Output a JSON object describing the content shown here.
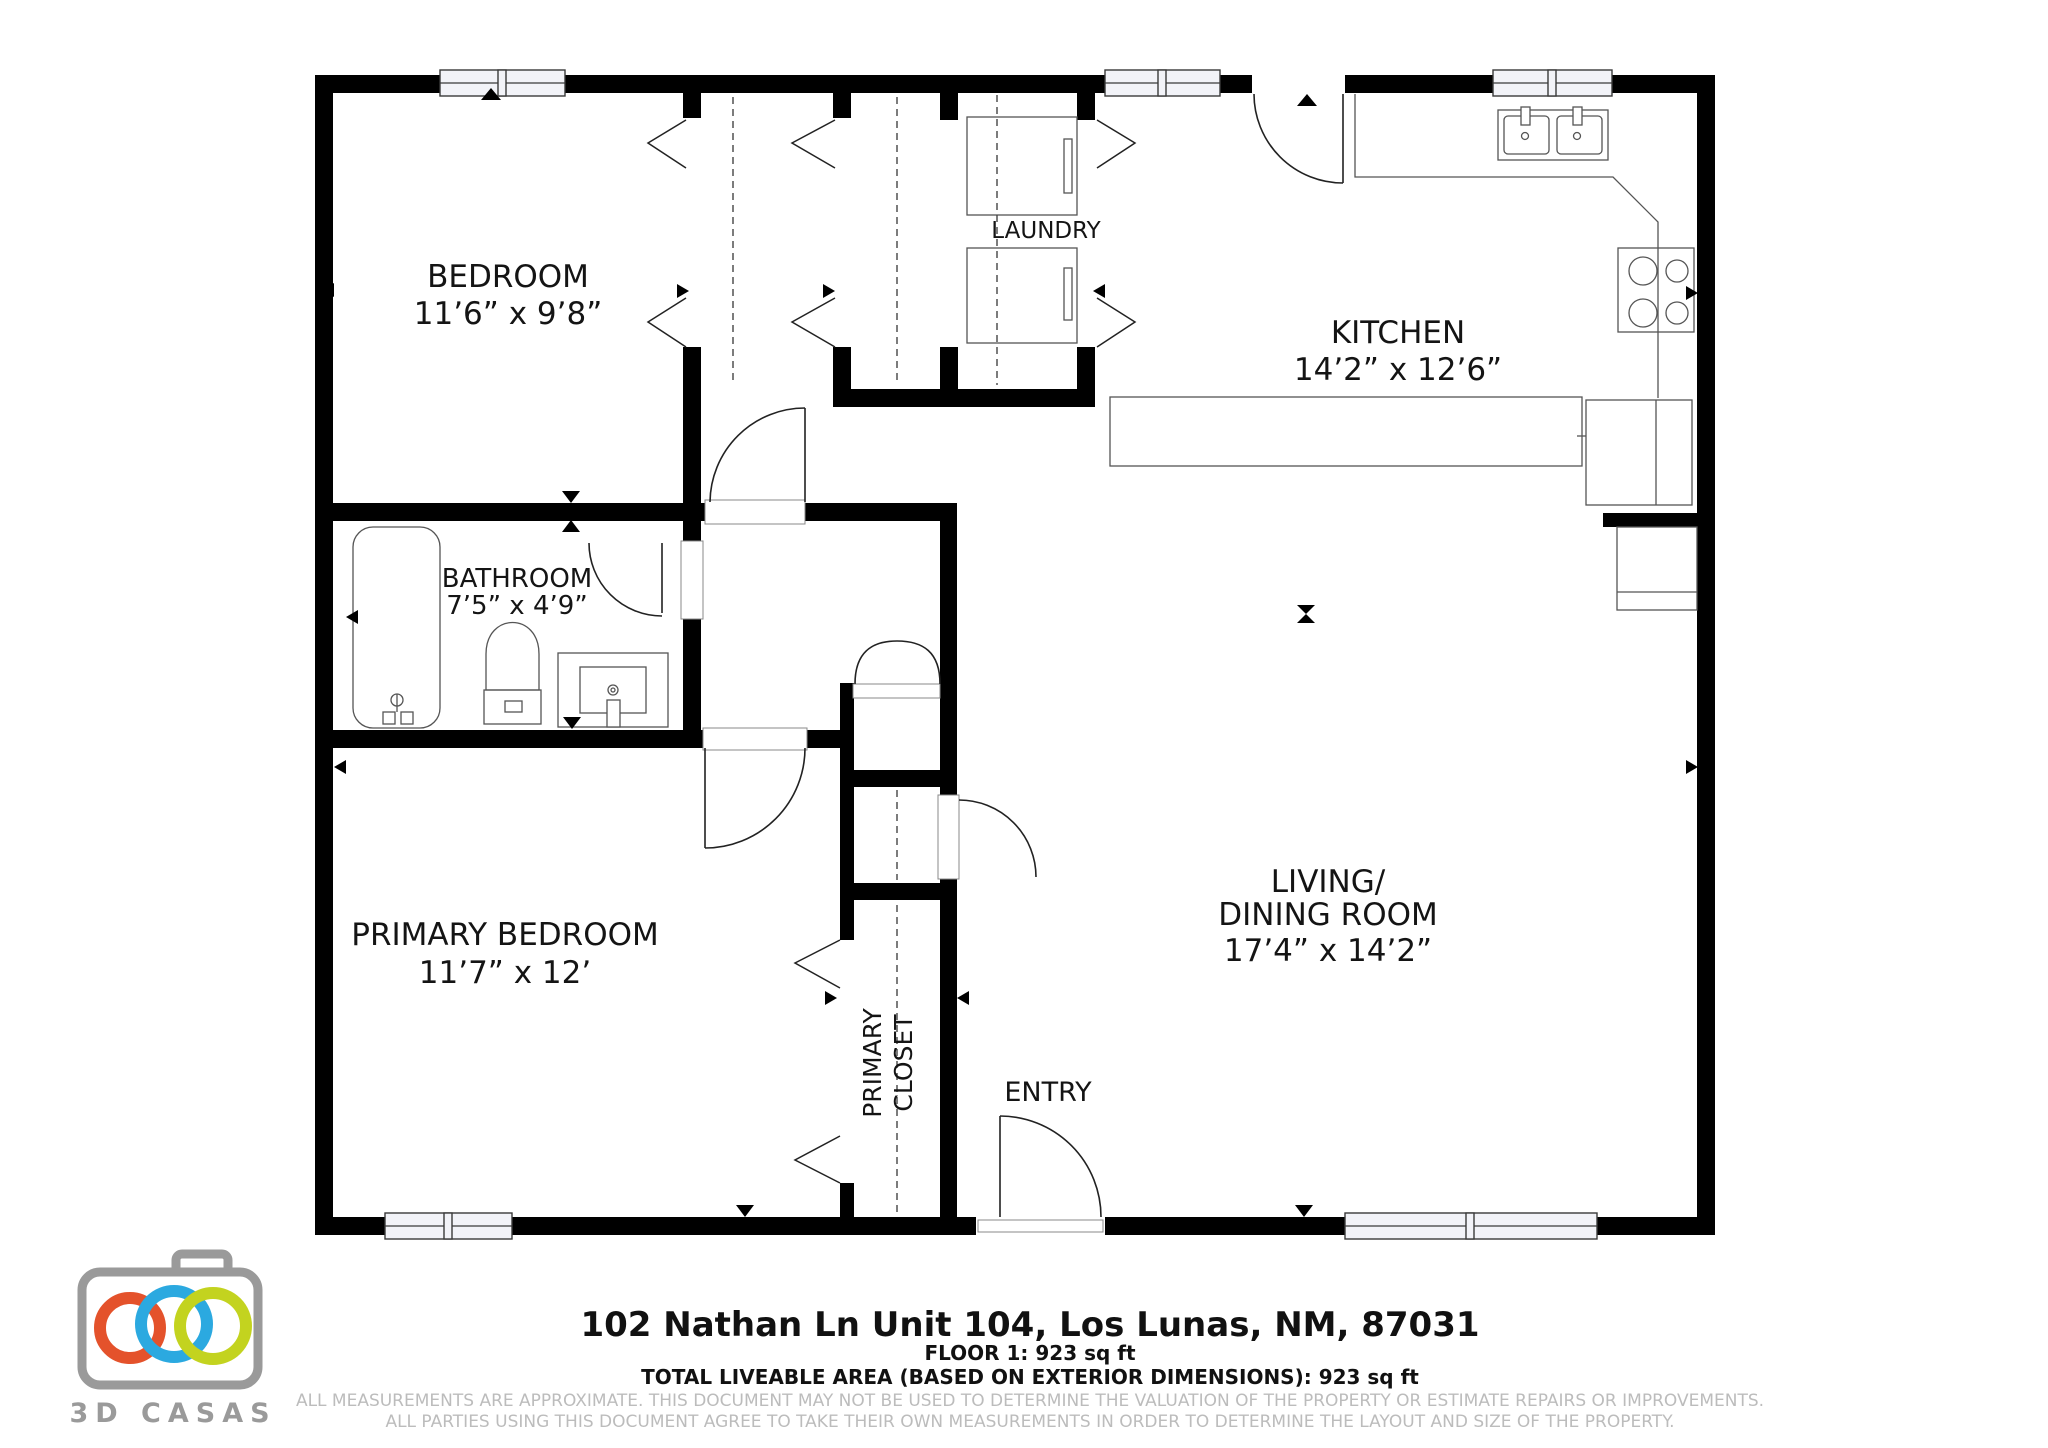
{
  "plan": {
    "rooms": {
      "bedroom": {
        "label": "BEDROOM",
        "dims": "11’6” x 9’8”"
      },
      "laundry": {
        "label": "LAUNDRY"
      },
      "kitchen": {
        "label": "KITCHEN",
        "dims": "14’2” x 12’6”"
      },
      "bathroom": {
        "label": "BATHROOM",
        "dims": "7’5” x 4’9”"
      },
      "living_dining": {
        "label1": "LIVING/",
        "label2": "DINING ROOM",
        "dims": "17’4” x 14’2”"
      },
      "primary_bedroom": {
        "label": "PRIMARY BEDROOM",
        "dims": "11’7” x 12’"
      },
      "primary_closet": {
        "label1": "PRIMARY",
        "label2": "CLOSET"
      },
      "entry": {
        "label": "ENTRY"
      }
    }
  },
  "footer": {
    "address": "102 Nathan Ln Unit 104, Los Lunas, NM, 87031",
    "floor_area": "FLOOR 1: 923 sq ft",
    "total_area": "TOTAL LIVEABLE AREA (BASED ON EXTERIOR DIMENSIONS): 923 sq ft",
    "disclaimer1": "ALL MEASUREMENTS ARE APPROXIMATE. THIS DOCUMENT MAY NOT BE USED TO DETERMINE THE VALUATION OF THE PROPERTY OR ESTIMATE REPAIRS OR IMPROVEMENTS.",
    "disclaimer2": "ALL PARTIES USING THIS DOCUMENT AGREE TO TAKE THEIR OWN MEASUREMENTS IN ORDER TO DETERMINE THE LAYOUT AND SIZE OF THE PROPERTY."
  },
  "logo": {
    "brand": "3D CASAS",
    "colors": {
      "orange": "#e4522b",
      "blue": "#2ba9e0",
      "green": "#c3d31f",
      "gray": "#9a9a9a"
    }
  }
}
